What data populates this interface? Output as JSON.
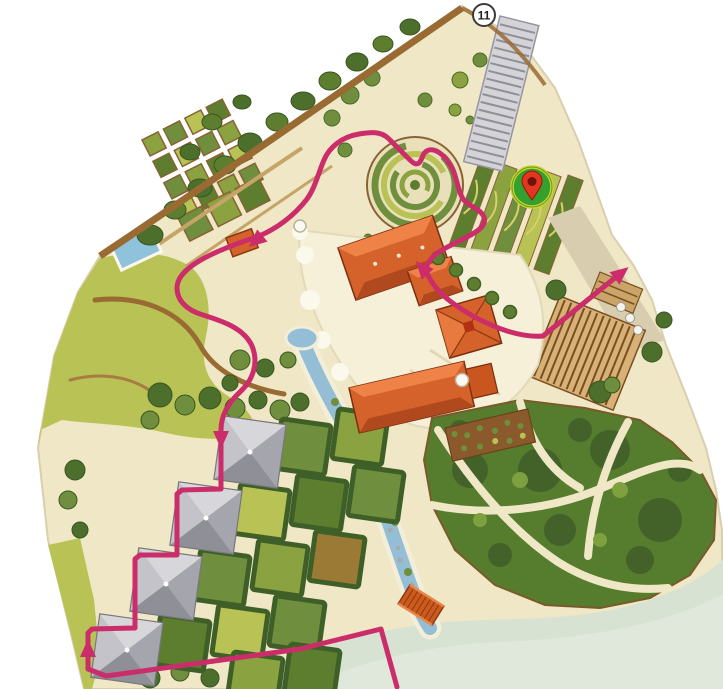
{
  "map": {
    "kind": "illustrated-garden-park-map",
    "badge": {
      "label": "11",
      "transform": "translate(484,15)"
    },
    "marker": {
      "icon": "location-pin-icon",
      "transform": "translate(532,187)"
    },
    "route": {
      "color": "#cb2d6b",
      "main_path_d": "M 397,687 L 381,629 L 300,649 L 200,663 L 106,676 L 88,669 L 88,633 L 92,629 L 135,628 L 135,559 L 140,555 L 177,555 L 177,494 L 182,490 L 221,489 L 221,430 C 221,415 228,403 240,392 C 253,380 259,363 252,346 C 244,328 222,321 203,315 C 186,310 177,300 177,288 C 177,273 196,261 219,251 C 233,245 247,240 259,236 C 276,229 294,216 307,199 C 315,188 318,174 324,160 C 329,148 341,137 359,134 C 371,132 381,131 389,139 C 396,146 402,152 406,156 C 411,161 415,166 419,163 C 423,159 422,152 429,150 C 437,148 446,157 452,168 C 457,177 457,189 463,199 C 469,207 480,208 484,217 C 487,226 477,232 465,238 C 452,245 437,251 431,259 C 427,264 426,268 425,270",
      "exit_path_d": "M 427,273 C 431,283 441,295 454,304 C 468,314 486,324 507,331 C 520,335 532,337 543,336 L 616,277",
      "arrows": [
        {
          "transform": "translate(88,650) rotate(0)"
        },
        {
          "transform": "translate(221,438) rotate(180)"
        },
        {
          "transform": "translate(257,240) rotate(230)"
        },
        {
          "transform": "translate(423,269) rotate(-42)"
        },
        {
          "transform": "translate(620,274) rotate(51)"
        }
      ]
    },
    "colors": {
      "background": "#ffffff",
      "map_base": "#efe7c6",
      "route_pink": "#cb2d6b",
      "roof_orange": "#d4622a",
      "water_blue": "#93bed6",
      "lake_pale": "#d7e2d2",
      "meadow_olive": "#b9c254",
      "hedge_dark": "#3f5f28",
      "garden_green": "#5d7e2e",
      "pyramid_gray": "#c3c3c9",
      "path_brown": "#9a6a33",
      "pin_green": "#34a02e",
      "pin_ring_yellow": "#cfd22f",
      "pin_red": "#e23522",
      "badge_fill": "#ffffff"
    }
  }
}
